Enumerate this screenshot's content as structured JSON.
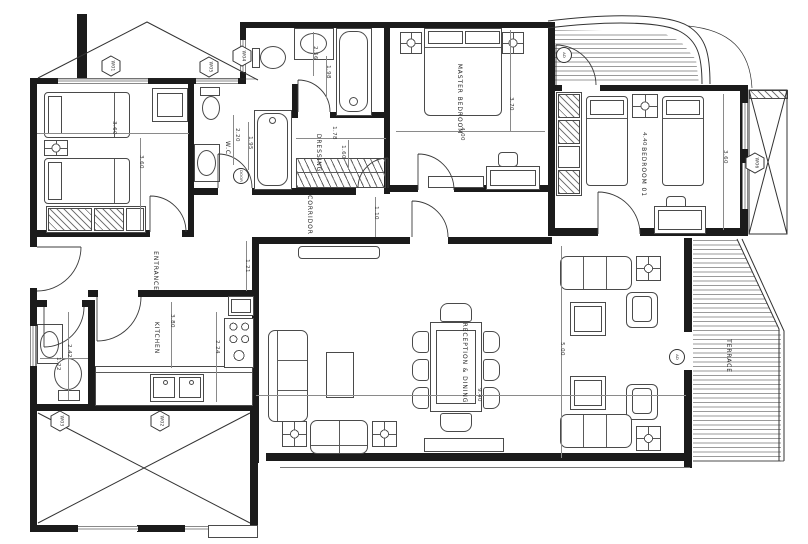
{
  "plan": {
    "drawing_type": "apartment floor plan",
    "colors": {
      "wall": "#1b1b1b",
      "furniture_line": "#4a4a4a",
      "dimension_line": "#8a8a8a",
      "window": "#888888"
    },
    "room_labels": [
      {
        "text": "ENTRANCE",
        "x": 155,
        "y": 271
      },
      {
        "text": "KITCHEN",
        "x": 156,
        "y": 338
      },
      {
        "text": "CORRIDOR",
        "x": 309,
        "y": 215
      },
      {
        "text": "W.C",
        "x": 227,
        "y": 148
      },
      {
        "text": "DRESSING",
        "x": 318,
        "y": 153
      },
      {
        "text": "MASTER BEDROOM",
        "x": 459,
        "y": 99
      },
      {
        "text": "BEDROOM 01",
        "x": 643,
        "y": 172
      },
      {
        "text": "RECEPTION  &  DINING",
        "x": 464,
        "y": 363
      },
      {
        "text": "TERRACE",
        "x": 728,
        "y": 356
      }
    ],
    "dimensions": [
      {
        "text": "3.60",
        "x": 113,
        "y": 128
      },
      {
        "text": "3.60",
        "x": 140,
        "y": 162
      },
      {
        "text": "2.20",
        "x": 236,
        "y": 135
      },
      {
        "text": "1.95",
        "x": 249,
        "y": 143
      },
      {
        "text": "2.56",
        "x": 314,
        "y": 53
      },
      {
        "text": "1.98",
        "x": 327,
        "y": 72
      },
      {
        "text": "1.78",
        "x": 333,
        "y": 133
      },
      {
        "text": "1.60",
        "x": 342,
        "y": 152
      },
      {
        "text": "4.00",
        "x": 461,
        "y": 134
      },
      {
        "text": "3.70",
        "x": 510,
        "y": 104
      },
      {
        "text": "4.40",
        "x": 643,
        "y": 139
      },
      {
        "text": "3.60",
        "x": 724,
        "y": 157
      },
      {
        "text": "1.10",
        "x": 375,
        "y": 213
      },
      {
        "text": "1.21",
        "x": 246,
        "y": 266
      },
      {
        "text": "3.80",
        "x": 171,
        "y": 321
      },
      {
        "text": "2.24",
        "x": 216,
        "y": 347
      },
      {
        "text": "2.42",
        "x": 68,
        "y": 351
      },
      {
        "text": "1.22",
        "x": 57,
        "y": 364
      },
      {
        "text": "5.00",
        "x": 561,
        "y": 349
      },
      {
        "text": "9.40",
        "x": 478,
        "y": 395
      }
    ],
    "window_tags": [
      {
        "text": "W01",
        "x": 111,
        "y": 66
      },
      {
        "text": "W05",
        "x": 209,
        "y": 67
      },
      {
        "text": "W04",
        "x": 242,
        "y": 56
      },
      {
        "text": "W06",
        "x": 755,
        "y": 163
      },
      {
        "text": "W03",
        "x": 60,
        "y": 421
      },
      {
        "text": "W02",
        "x": 160,
        "y": 421
      }
    ],
    "circle_tags": [
      {
        "text": "AD",
        "x": 564,
        "y": 55
      },
      {
        "text": "AD",
        "x": 677,
        "y": 357
      },
      {
        "text": "DOOR",
        "x": 241,
        "y": 176
      }
    ]
  }
}
